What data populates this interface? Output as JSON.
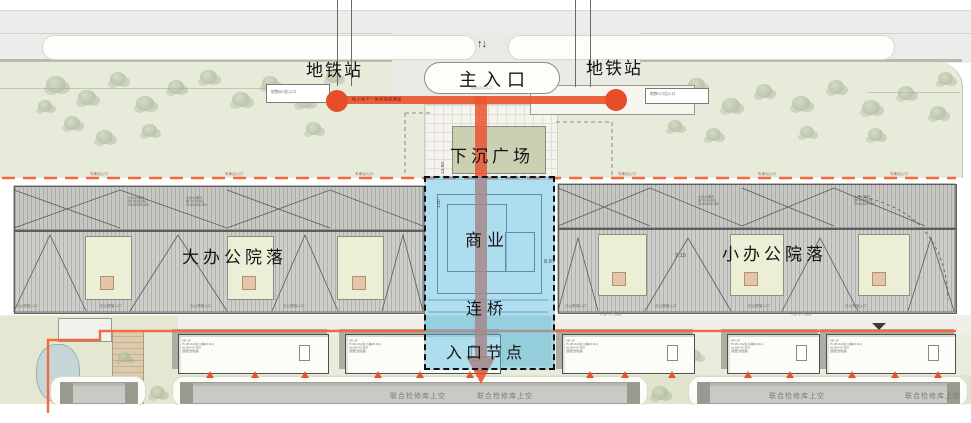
{
  "labels": {
    "subway_left": "地铁站",
    "subway_right": "地铁站",
    "main_entrance": "主入口",
    "sunken_plaza": "下沉广场",
    "commercial": "商业",
    "bridge": "连桥",
    "entrance_node": "入口节点",
    "large_office": "大办公院落",
    "small_office": "小办公院落",
    "two_way_arrows": "↑↓"
  },
  "tiny": {
    "subway_exit_left": "地铁B口出入口",
    "subway_exit_right": "地铁C口出入口",
    "main_entrance_sub": "综合中心入口",
    "flow_line": "地上地下一体化连接通道",
    "garage_entry": "车库出入口",
    "office_entry": "办公院落入口",
    "road_note": "内部车行道路"
  },
  "dims": {
    "plaza_top": "13.90",
    "plaza_inner": "1.00",
    "grid_a": "7.15",
    "grid_b": "7.20",
    "grid_c": "8.97"
  },
  "depot_label": "联合检修库上空",
  "dorm_annotation": [
    "6F/-1F",
    "H=26.3m(女儿墙26.3m)",
    "±0.00=73.900",
    "(装配式建造)"
  ],
  "office_annotation": [
    "小办公单元",
    "6F H=24.0m",
    "23.400/26.400"
  ],
  "colors": {
    "circulation": "#ea5430",
    "node": "#e64e2a",
    "highlight_fill": "rgba(96,190,228,0.5)",
    "boundary_dash": "#f26a40"
  }
}
